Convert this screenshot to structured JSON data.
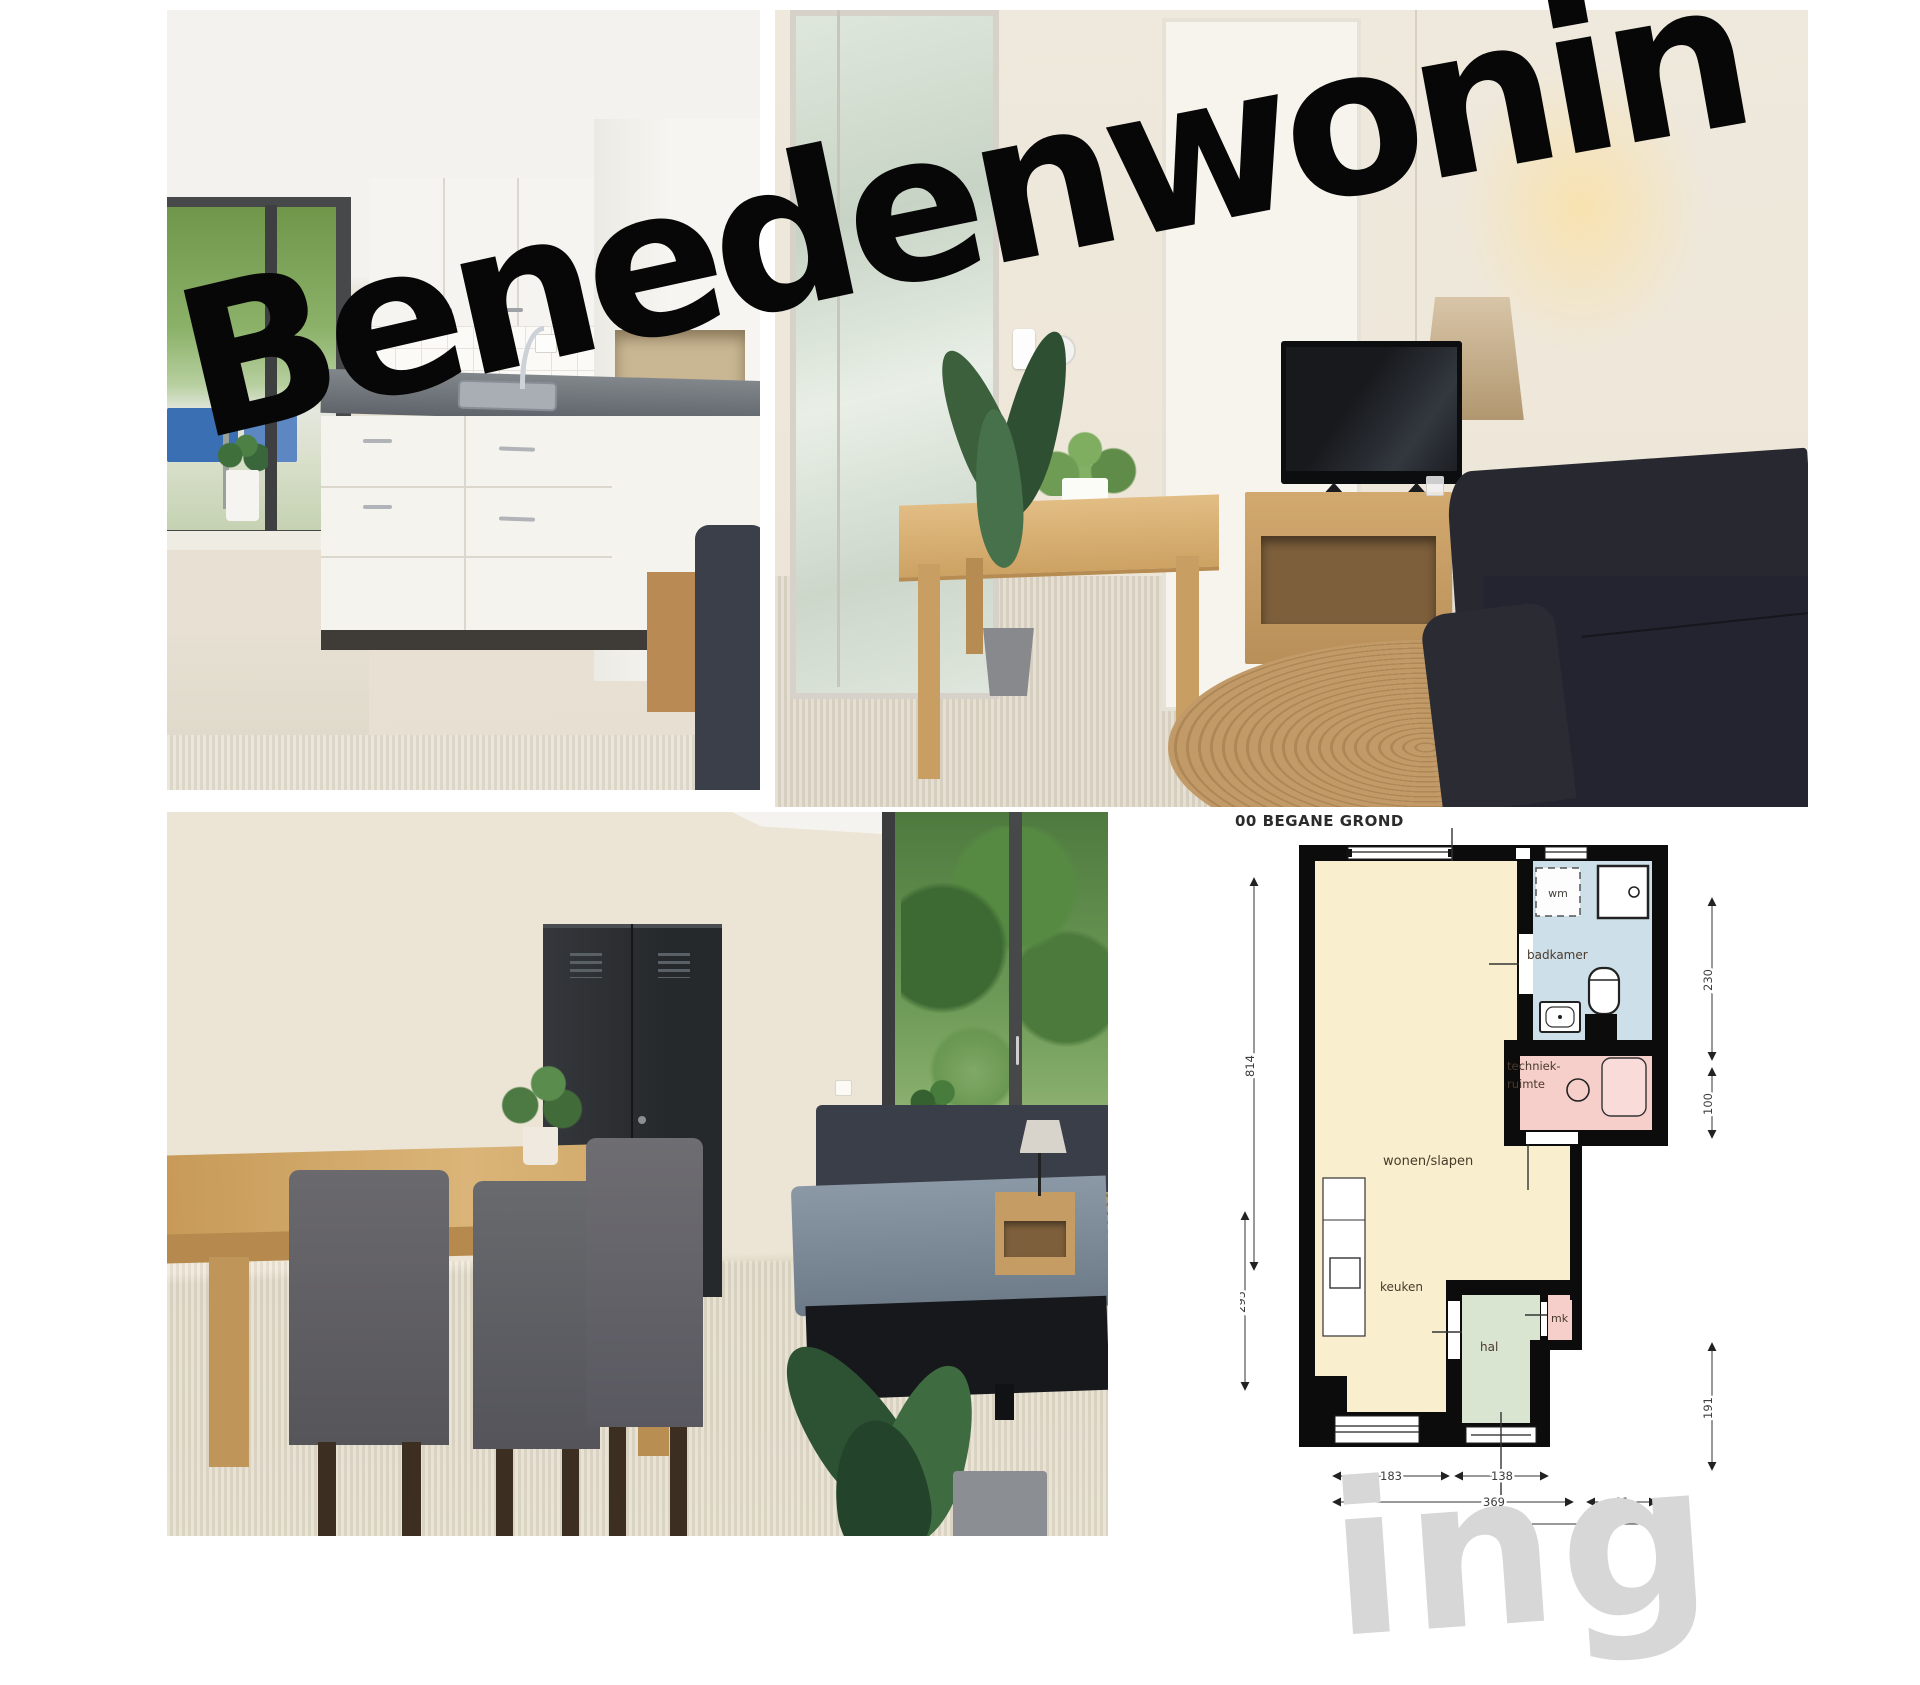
{
  "title": {
    "text": "Benedenwoning",
    "color": "#070707"
  },
  "watermark": {
    "text": "ing",
    "color": "#d7d7d7"
  },
  "floorplan": {
    "title": "00 BEGANE GROND",
    "rooms": {
      "wonen_slapen": "wonen/slapen",
      "keuken": "keuken",
      "badkamer": "badkamer",
      "techniek_line1": "techniek-",
      "techniek_line2": "ruimte",
      "hal": "hal",
      "wm": "wm",
      "mk": "mk"
    },
    "dimensions": {
      "left": [
        "814",
        "295"
      ],
      "right": [
        "230",
        "100",
        "191"
      ],
      "bottom_row1": [
        "183",
        "138"
      ],
      "bottom_row2": [
        "369",
        "01"
      ]
    },
    "colors": {
      "wonen_slapen": "#f9eecd",
      "badkamer": "#cddfe9",
      "techniek_ruimte": "#f6cfcb",
      "hal": "#d9e4d1",
      "mk": "#f6cfcb",
      "wall": "#0c0c0c"
    }
  }
}
